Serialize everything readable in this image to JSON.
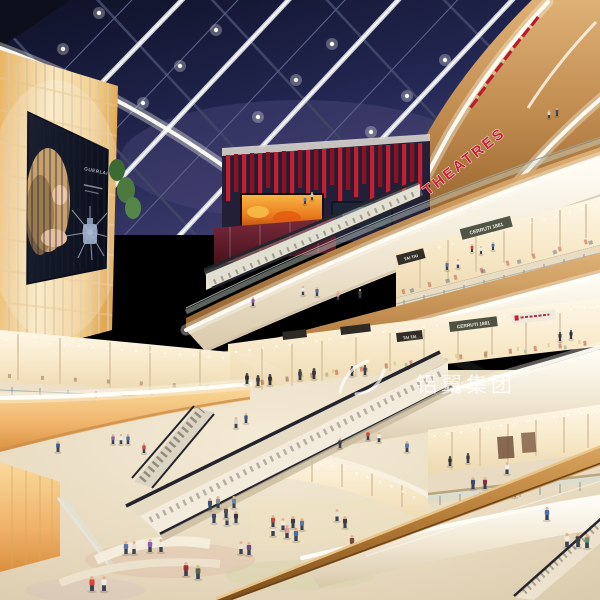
{
  "signs": {
    "theatres": "THEATRES",
    "tai_tai": "TAI TAI",
    "cerruti_1881": "CERRUTI 1881"
  },
  "billboard": {
    "brand": "GUERLAIN"
  },
  "watermark": {
    "text": "铝翼集团"
  },
  "colors": {
    "sky_navy": "#1c2144",
    "accent_red": "#c22030",
    "led_orange": "#e8761f",
    "wall_glow": "#f7dfae",
    "fascia_cream": "#f3ead7",
    "wood": "#c08b4e",
    "floor_beige": "#e8dcc5",
    "glass_tint": "#cfe0da",
    "watermark_white": "#ffffff"
  },
  "people": [
    {
      "x": 92,
      "y": 591,
      "h": 15,
      "c": "#d9453a"
    },
    {
      "x": 104,
      "y": 591,
      "h": 15,
      "c": "#efece4"
    },
    {
      "x": 126,
      "y": 554,
      "h": 13,
      "c": "#5a76a8"
    },
    {
      "x": 134,
      "y": 554,
      "h": 13,
      "c": "#e8e2d6"
    },
    {
      "x": 150,
      "y": 552,
      "h": 13,
      "c": "#8a5fb0"
    },
    {
      "x": 161,
      "y": 552,
      "h": 13,
      "c": "#efece4"
    },
    {
      "x": 186,
      "y": 576,
      "h": 14,
      "c": "#9a2f35"
    },
    {
      "x": 198,
      "y": 579,
      "h": 14,
      "c": "#55684a"
    },
    {
      "x": 214,
      "y": 523,
      "h": 12,
      "c": "#3d4a6b"
    },
    {
      "x": 227,
      "y": 525,
      "h": 12,
      "c": "#c8c8c8"
    },
    {
      "x": 236,
      "y": 523,
      "h": 12,
      "c": "#34343a"
    },
    {
      "x": 241,
      "y": 554,
      "h": 13,
      "c": "#e8e2d6"
    },
    {
      "x": 249,
      "y": 555,
      "h": 13,
      "c": "#6b4a8a"
    },
    {
      "x": 273,
      "y": 536,
      "h": 13,
      "c": "#efece4"
    },
    {
      "x": 287,
      "y": 538,
      "h": 13,
      "c": "#d9a0a8"
    },
    {
      "x": 296,
      "y": 541,
      "h": 13,
      "c": "#4a6fa5"
    },
    {
      "x": 337,
      "y": 521,
      "h": 12,
      "c": "#e8e2d6"
    },
    {
      "x": 345,
      "y": 528,
      "h": 12,
      "c": "#3d3d3d"
    },
    {
      "x": 352,
      "y": 548,
      "h": 13,
      "c": "#7a4a3a"
    },
    {
      "x": 210,
      "y": 510,
      "h": 12,
      "c": "#35507a"
    },
    {
      "x": 218,
      "y": 508,
      "h": 12,
      "c": "#8a8f98"
    },
    {
      "x": 226,
      "y": 518,
      "h": 12,
      "c": "#4a4f58"
    },
    {
      "x": 234,
      "y": 508,
      "h": 12,
      "c": "#6a86b0"
    },
    {
      "x": 273,
      "y": 527,
      "h": 12,
      "c": "#c8473c"
    },
    {
      "x": 283,
      "y": 530,
      "h": 12,
      "c": "#efece4"
    },
    {
      "x": 293,
      "y": 528,
      "h": 12,
      "c": "#3d3d44"
    },
    {
      "x": 302,
      "y": 530,
      "h": 12,
      "c": "#5a76a8"
    },
    {
      "x": 236,
      "y": 428,
      "h": 11,
      "c": "#d9d2c8"
    },
    {
      "x": 246,
      "y": 423,
      "h": 10,
      "c": "#4a5a7a"
    },
    {
      "x": 58,
      "y": 452,
      "h": 11,
      "c": "#3d5a8a"
    },
    {
      "x": 113,
      "y": 444,
      "h": 10,
      "c": "#8a5fb0"
    },
    {
      "x": 121,
      "y": 444,
      "h": 10,
      "c": "#efece4"
    },
    {
      "x": 128,
      "y": 444,
      "h": 10,
      "c": "#4a6fa5"
    },
    {
      "x": 144,
      "y": 453,
      "h": 10,
      "c": "#c8473c"
    },
    {
      "x": 340,
      "y": 448,
      "h": 10,
      "c": "#3d3d44"
    },
    {
      "x": 368,
      "y": 440,
      "h": 10,
      "c": "#c8473c"
    },
    {
      "x": 379,
      "y": 442,
      "h": 10,
      "c": "#efece4"
    },
    {
      "x": 407,
      "y": 452,
      "h": 11,
      "c": "#5a76a8"
    },
    {
      "x": 473,
      "y": 489,
      "h": 12,
      "c": "#3d4a6b"
    },
    {
      "x": 485,
      "y": 489,
      "h": 12,
      "c": "#8a2f3a"
    },
    {
      "x": 507,
      "y": 474,
      "h": 12,
      "c": "#efece4"
    },
    {
      "x": 514,
      "y": 497,
      "h": 13,
      "c": "#9a8fb8"
    },
    {
      "x": 547,
      "y": 520,
      "h": 13,
      "c": "#4a6fa5"
    },
    {
      "x": 567,
      "y": 547,
      "h": 14,
      "c": "#efece4"
    },
    {
      "x": 578,
      "y": 547,
      "h": 14,
      "c": "#3d3d44"
    },
    {
      "x": 587,
      "y": 548,
      "h": 14,
      "c": "#6b8f67"
    },
    {
      "x": 253,
      "y": 306,
      "h": 9,
      "c": "#8a5fb0"
    },
    {
      "x": 303,
      "y": 295,
      "h": 9,
      "c": "#efece4"
    },
    {
      "x": 317,
      "y": 296,
      "h": 9,
      "c": "#4a6fa5"
    },
    {
      "x": 338,
      "y": 300,
      "h": 9,
      "c": "#d9a0a8"
    },
    {
      "x": 360,
      "y": 298,
      "h": 9,
      "c": "#3d3d44"
    },
    {
      "x": 447,
      "y": 270,
      "h": 9,
      "c": "#5a76a8"
    },
    {
      "x": 458,
      "y": 268,
      "h": 9,
      "c": "#efece4"
    },
    {
      "x": 472,
      "y": 252,
      "h": 8,
      "c": "#c8473c"
    },
    {
      "x": 481,
      "y": 254,
      "h": 8,
      "c": "#efece4"
    },
    {
      "x": 493,
      "y": 250,
      "h": 8,
      "c": "#4a6fa5"
    },
    {
      "x": 312,
      "y": 200,
      "h": 8,
      "c": "#c8c8c8"
    },
    {
      "x": 305,
      "y": 204,
      "h": 8,
      "c": "#5a76a8"
    },
    {
      "x": 549,
      "y": 118,
      "h": 8,
      "c": "#d9d2c8"
    },
    {
      "x": 557,
      "y": 116,
      "h": 8,
      "c": "#4a4a52"
    },
    {
      "x": 247,
      "y": 384,
      "h": 11,
      "c": "#2e2e33",
      "m": 1
    },
    {
      "x": 258,
      "y": 386,
      "h": 11,
      "c": "#3a3a40",
      "m": 1
    },
    {
      "x": 270,
      "y": 385,
      "h": 11,
      "c": "#2e2e33",
      "m": 1
    },
    {
      "x": 300,
      "y": 380,
      "h": 11,
      "c": "#44444c",
      "m": 1
    },
    {
      "x": 314,
      "y": 379,
      "h": 11,
      "c": "#33333a",
      "m": 1
    },
    {
      "x": 352,
      "y": 376,
      "h": 10,
      "c": "#2e2e33",
      "m": 1
    },
    {
      "x": 365,
      "y": 375,
      "h": 10,
      "c": "#44444c",
      "m": 1
    },
    {
      "x": 560,
      "y": 341,
      "h": 9,
      "c": "#33333a",
      "m": 1
    },
    {
      "x": 571,
      "y": 339,
      "h": 9,
      "c": "#2e2e33",
      "m": 1
    },
    {
      "x": 450,
      "y": 466,
      "h": 10,
      "c": "#2e2e33",
      "m": 1
    },
    {
      "x": 468,
      "y": 463,
      "h": 10,
      "c": "#3a3a40",
      "m": 1
    }
  ]
}
